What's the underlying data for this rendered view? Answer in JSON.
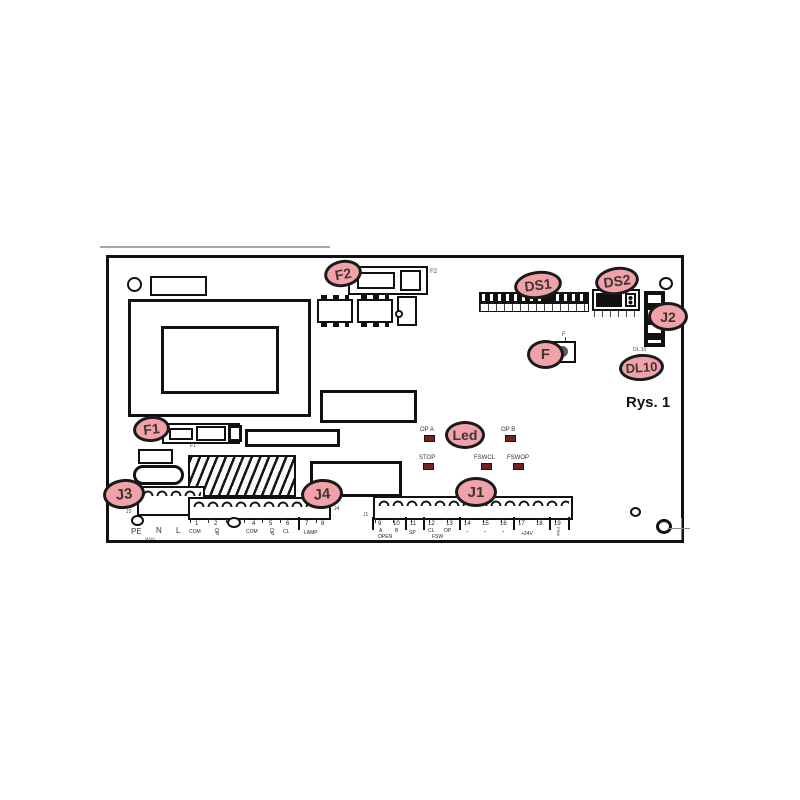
{
  "caption": "Rys. 1",
  "colors": {
    "callout_fill": "#f0a2a8",
    "callout_border": "#1a1a1a",
    "led_indicator": "#702525",
    "line": "#111111"
  },
  "callouts": [
    {
      "id": "f2",
      "label": "F2"
    },
    {
      "id": "ds1",
      "label": "DS1"
    },
    {
      "id": "ds2",
      "label": "DS2"
    },
    {
      "id": "j2",
      "label": "J2"
    },
    {
      "id": "f",
      "label": "F"
    },
    {
      "id": "dl10",
      "label": "DL10"
    },
    {
      "id": "led",
      "label": "Led"
    },
    {
      "id": "f1",
      "label": "F1"
    },
    {
      "id": "j3",
      "label": "J3"
    },
    {
      "id": "j4",
      "label": "J4"
    },
    {
      "id": "j1",
      "label": "J1"
    }
  ],
  "refs": {
    "f2": "F2",
    "f1": "F1",
    "f": "F",
    "dl10": "DL.10",
    "j3": "J3",
    "j4": "J4",
    "j1": "J1"
  },
  "leds": {
    "op_a": "OP A",
    "op_b": "OP B",
    "stop": "STOP",
    "fswcl": "FSWCL",
    "fswop": "FSWOP"
  },
  "j3_terminal": {
    "pe": "PE",
    "n": "N",
    "l": "L",
    "sub": "MAIN"
  },
  "j4_block": {
    "numbers": [
      "1",
      "2",
      "4",
      "5",
      "6",
      "7",
      "8"
    ],
    "com1": "COM",
    "op1": "OP",
    "com2": "COM",
    "op2": "OP",
    "cl": "CL",
    "lamp": "LAMP"
  },
  "j1_block": {
    "numbers": [
      "9",
      "10",
      "11",
      "12",
      "13",
      "14",
      "15",
      "16",
      "17",
      "18",
      "19"
    ],
    "a": "A",
    "b": "B",
    "open": "OPEN",
    "sp": "SP",
    "cl": "CL",
    "op": "OP",
    "fsw": "FSW",
    "dash": "-",
    "plus24": "+24V",
    "fsw_tx": "FSW"
  }
}
